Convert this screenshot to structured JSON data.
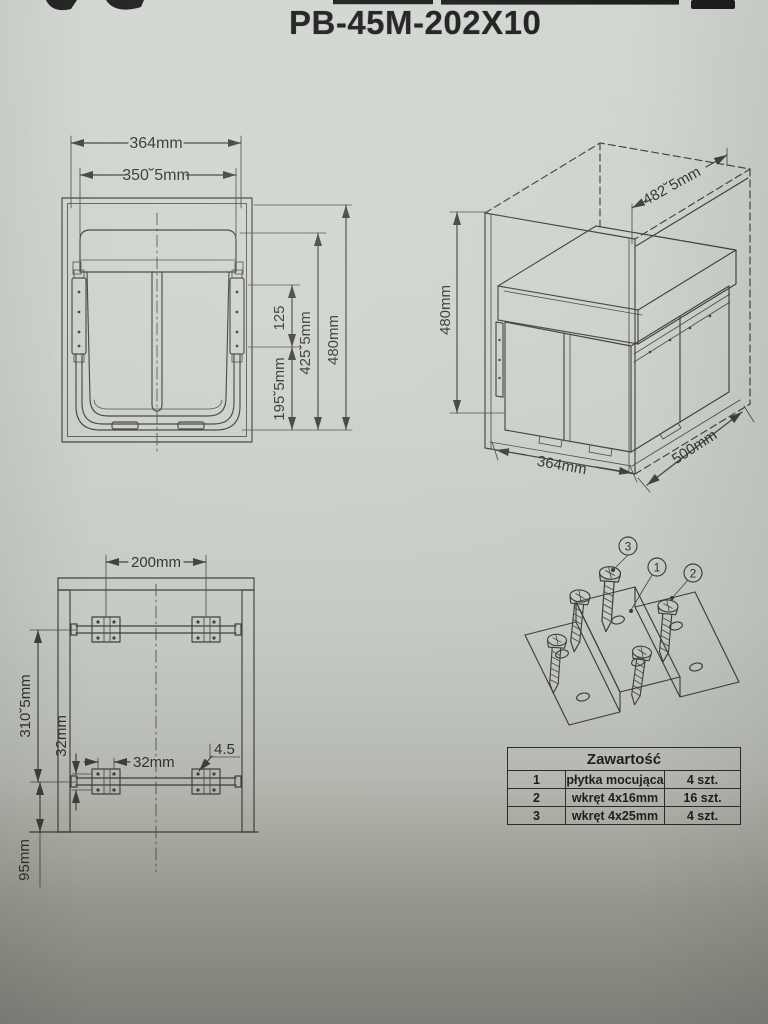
{
  "title": "PB-45M-202X10",
  "front_view": {
    "width_outer": "364mm",
    "width_inner": "350˘5mm",
    "slide_height": "125",
    "body_height": "425˘5mm",
    "total_height": "480mm",
    "lower_height": "195˘5mm"
  },
  "iso_view": {
    "depth_inner": "482˘5mm",
    "height": "480mm",
    "width": "364mm",
    "depth": "500mm"
  },
  "mounting_view": {
    "plate_spacing": "200mm",
    "rail_spacing": "310˘5mm",
    "hole_spacing_vertical": "32mm",
    "hole_spacing_horizontal": "32mm",
    "hole_diameter": "4.5",
    "bottom_offset": "95mm"
  },
  "hardware": {
    "callout_1": "1",
    "callout_2": "2",
    "callout_3": "3"
  },
  "parts_table": {
    "title": "Zawartość",
    "rows": [
      {
        "no": "1",
        "name": "płytka mocująca",
        "qty": "4 szt."
      },
      {
        "no": "2",
        "name": "wkręt 4x16mm",
        "qty": "16 szt."
      },
      {
        "no": "3",
        "name": "wkręt 4x25mm",
        "qty": "4 szt."
      }
    ]
  },
  "colors": {
    "line": "#3f3e39",
    "paper_light": "#d1d6d0",
    "paper_dark": "#8d9188",
    "ink": "#1c1c1c"
  }
}
